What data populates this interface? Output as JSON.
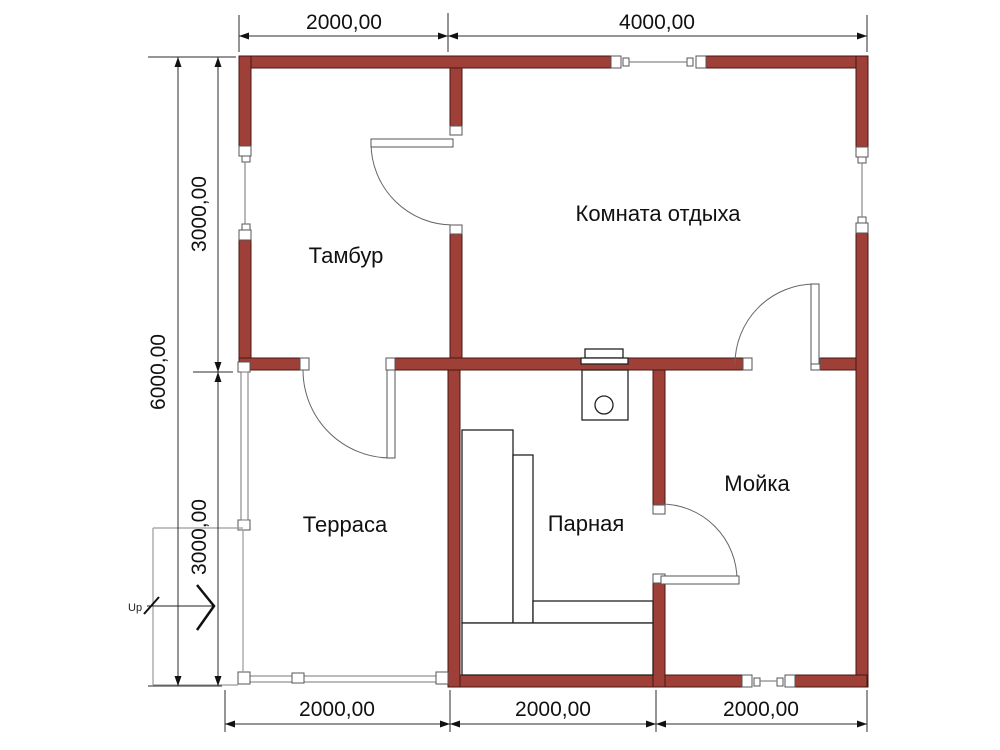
{
  "rooms": {
    "vestibule": {
      "label": "Тамбур"
    },
    "lounge": {
      "label": "Комната отдыха"
    },
    "terrace": {
      "label": "Терраса"
    },
    "steam_room": {
      "label": "Парная"
    },
    "washroom": {
      "label": "Мойка"
    }
  },
  "dimensions": {
    "top": {
      "d1": "2000,00",
      "d2": "4000,00"
    },
    "left": {
      "upper": "3000,00",
      "total": "6000,00",
      "lower": "3000,00"
    },
    "bottom": {
      "d1": "2000,00",
      "d2": "2000,00",
      "d3": "2000,00"
    }
  },
  "stairs": {
    "up_label": "Up"
  },
  "colors": {
    "wall_fill": "#9E4038",
    "wall_edge": "#451712",
    "dim_color": "#2b2b2b",
    "light_line": "#9a9a9a",
    "door_line": "#666666"
  }
}
